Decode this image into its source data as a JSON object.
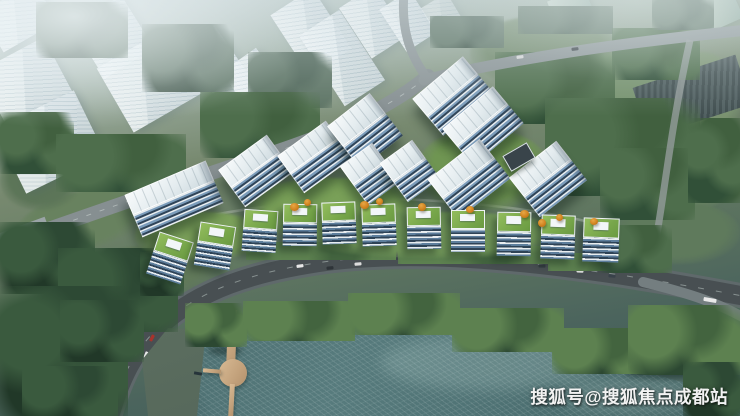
{
  "image": {
    "type": "aerial-architectural-rendering",
    "subject": "riverside residential development rendering: high-rise towers, green-roof low-rise row, lakeside road, lake with boardwalk pier, background city massing",
    "width": 740,
    "height": 416
  },
  "watermark": {
    "text": "搜狐号@搜狐焦点成都站",
    "color": "#f2f2f2"
  },
  "palette": {
    "haze": "#dde8ec",
    "ghost_building": "#e9f0f3",
    "tree_dark": "#2f4b3a",
    "tree_light": "#5d8150",
    "park_grass": "#74906c",
    "estate_lawn": "#7ba05a",
    "tower_roof": "#eef3f6",
    "tower_glass": "#7b9cba",
    "tower_stripe_dark": "#2f4458",
    "lowrise_roof_green": "#86b054",
    "road_asphalt": "#484f52",
    "road_light": "#868f91",
    "lake": "#4a6c6e",
    "lake_sparkle": "#c6e0da",
    "pier_wood": "#c3a27c",
    "autumn_tree": "#d1831f",
    "car_red": "#a8332c"
  },
  "scene": {
    "background_city": {
      "name": "background city massing blocks",
      "building_count": 14
    },
    "estate": {
      "towers": {
        "name": "residential high-rise towers",
        "count": 10
      },
      "lowrise_row": {
        "name": "green-roof low-rise buildings along lakeside road",
        "count": 11
      },
      "clubhouse_count": 1
    },
    "park": {
      "name": "park green space with lawns and tree clusters"
    },
    "lake": {
      "name": "lake with sun sparkle"
    },
    "pier": {
      "name": "wooden boardwalk pier with round platform"
    },
    "roads": {
      "name": "road network",
      "car_count": 22
    }
  }
}
